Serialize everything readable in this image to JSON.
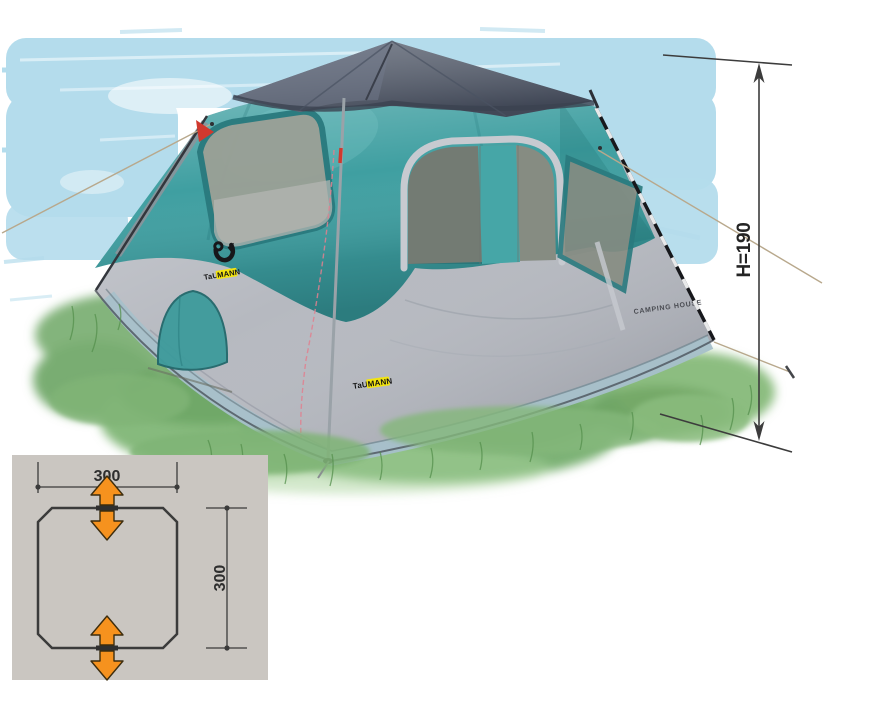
{
  "scene": {
    "background_color": "#ffffff",
    "sky_color": "#b4dcec",
    "grass_color": "#83b47c"
  },
  "tent": {
    "brand_prefix": "TaU",
    "brand_suffix": "MANN",
    "model_label": "CAMPING HOUSE",
    "colors": {
      "canopy": "#3f9fa1",
      "cap": "#5d6574",
      "skirt": "#b6b9c0",
      "base_band": "#a7c0ca",
      "mesh": "#9aa096",
      "mesh_dark": "#868c82",
      "trim": "#c7cad0",
      "accent_red": "#d0392e",
      "logo_yellow": "#f2e410",
      "rope": "#b8a88c"
    }
  },
  "annotations": {
    "height": {
      "label": "H=190",
      "line_color": "#3c3c3c"
    },
    "floor_plan": {
      "width_label": "300",
      "depth_label": "300",
      "panel_color": "#cac6c1",
      "outline_color": "#3b3b3b",
      "arrow_color": "#f6921e",
      "text_color": "#2e2e2e"
    }
  }
}
